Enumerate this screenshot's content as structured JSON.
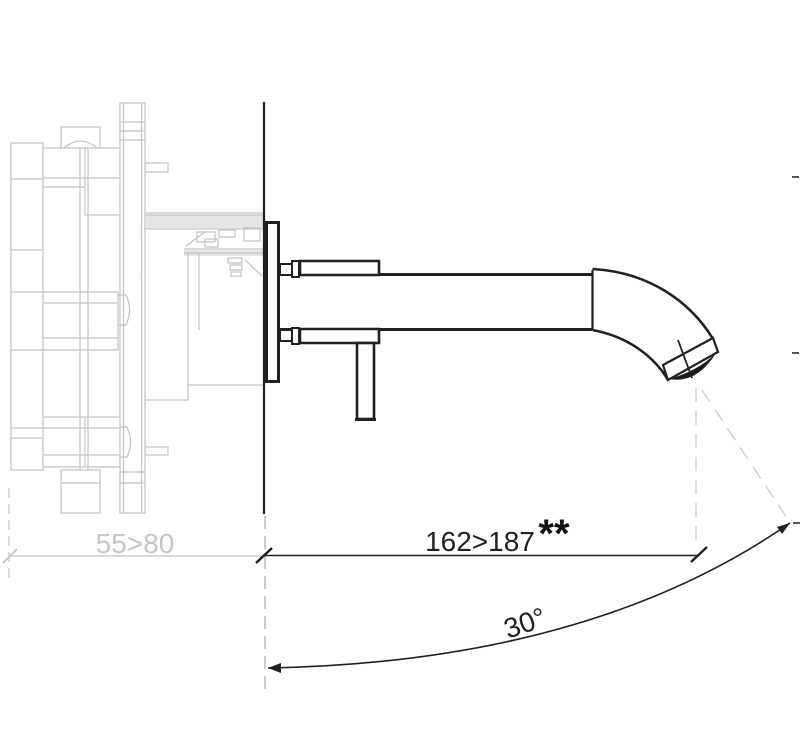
{
  "page": {
    "width": 800,
    "height": 743,
    "background": "#ffffff"
  },
  "drawing": {
    "colors": {
      "ink": "#212121",
      "ghost_line": "#c3c3c7",
      "ghost_fill": "#d0d0d3",
      "wall_dash": "#b2b2b6",
      "projection_dash": "#cfcfd2",
      "dimension_text": "#1f1f1f",
      "ghost_text": "#c5c5c8"
    }
  },
  "dimensions": {
    "concealed_depth": {
      "label": "55>80"
    },
    "spout_reach": {
      "label": "162>187",
      "note": "**"
    },
    "spout_angle": {
      "label": "30°"
    }
  }
}
